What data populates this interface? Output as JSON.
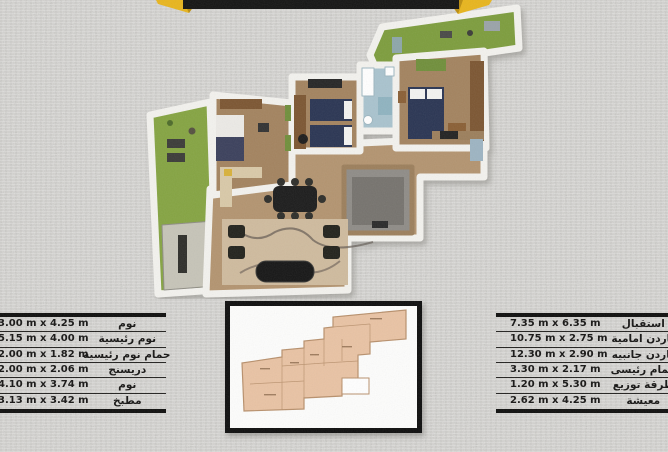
{
  "colors": {
    "frame": "#0e0e0e",
    "wall": "#f3f2ee",
    "wood": "#a3835f",
    "wood_light": "#b3946f",
    "garden": "#7d9d3e",
    "garden2": "#85a443",
    "bath": "#a9c3ce",
    "gray_room": "#8f8c87",
    "gray_rug": "#76736e",
    "bed_navy": "#2c3552",
    "rug_tan": "#cfbb9e",
    "salmon": "#e9c3a4",
    "salmon_line": "#b8906c",
    "banner_black": "#141413",
    "banner_yellow": "#e8b51d",
    "banner_yellow_dark": "#bb8d10",
    "paving": "#c6c4b8",
    "furniture_dark": "#24231f",
    "furniture_brown": "#7b5633"
  },
  "banner": {
    "description": "folded ribbon banner, text cut off at top edge"
  },
  "floor_plan_3d": {
    "description": "3d rendered top-down apartment floor plan"
  },
  "floor_plan_2d": {
    "description": "small 2d blueprint inset in black frame"
  },
  "left_table": {
    "rows": [
      {
        "name": "نوم",
        "dims": "3.00 m x 4.25 m"
      },
      {
        "name": "نوم رئيسية",
        "dims": "5.15 m x 4.00 m"
      },
      {
        "name": "حمام نوم رئيسية",
        "dims": "2.00 m x 1.82 m"
      },
      {
        "name": "دريسنج",
        "dims": "2.00 m x 2.06 m"
      },
      {
        "name": "نوم",
        "dims": "4.10 m x 3.74 m"
      },
      {
        "name": "مطبخ",
        "dims": "3.13 m x 3.42 m"
      }
    ]
  },
  "right_table": {
    "rows": [
      {
        "name": "استقبال",
        "dims": "7.35 m x 6.35 m"
      },
      {
        "name": "جاردن امامية",
        "dims": "10.75 m x 2.75 m"
      },
      {
        "name": "جاردن جانبيه",
        "dims": "12.30 m x 2.90 m"
      },
      {
        "name": "حمام رئيسى",
        "dims": "3.30 m x 2.17 m"
      },
      {
        "name": "طرقة توزيع",
        "dims": "1.20 m x 5.30 m"
      },
      {
        "name": "معيشة",
        "dims": "2.62 m x 4.25 m"
      }
    ]
  }
}
